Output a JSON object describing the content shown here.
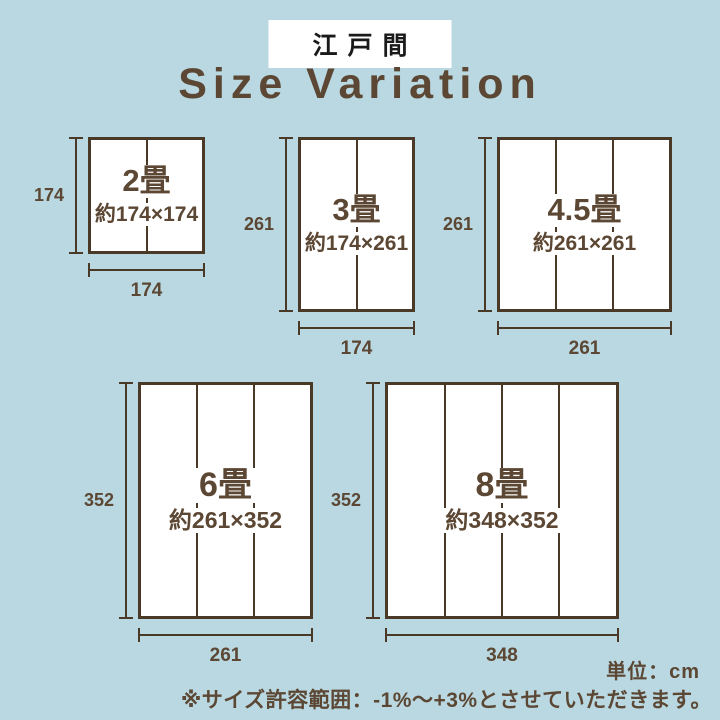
{
  "page": {
    "badge": "江戸間",
    "title": "Size Variation",
    "unit_note": "単位：cm",
    "tolerance_note": "※サイズ許容範囲：-1%〜+3%とさせていただきます。"
  },
  "colors": {
    "background": "#b9d8e1",
    "line_brown": "#4b3928",
    "text_brown": "#5b4733",
    "badge_background": "#ffffff",
    "badge_text": "#1a1a1a",
    "mat_background": "#ffffff"
  },
  "panels": [
    {
      "label": "2畳",
      "size_text": "約174×174",
      "height_label": "174",
      "width_label": "174",
      "width_cm": 174,
      "height_cm": 174,
      "mat_sections": 2
    },
    {
      "label": "3畳",
      "size_text": "約174×261",
      "height_label": "261",
      "width_label": "174",
      "width_cm": 174,
      "height_cm": 261,
      "mat_sections": 2
    },
    {
      "label": "4.5畳",
      "size_text": "約261×261",
      "height_label": "261",
      "width_label": "261",
      "width_cm": 261,
      "height_cm": 261,
      "mat_sections": 3
    },
    {
      "label": "6畳",
      "size_text": "約261×352",
      "height_label": "352",
      "width_label": "261",
      "width_cm": 261,
      "height_cm": 352,
      "mat_sections": 3
    },
    {
      "label": "8畳",
      "size_text": "約348×352",
      "height_label": "352",
      "width_label": "348",
      "width_cm": 348,
      "height_cm": 352,
      "mat_sections": 4
    }
  ]
}
